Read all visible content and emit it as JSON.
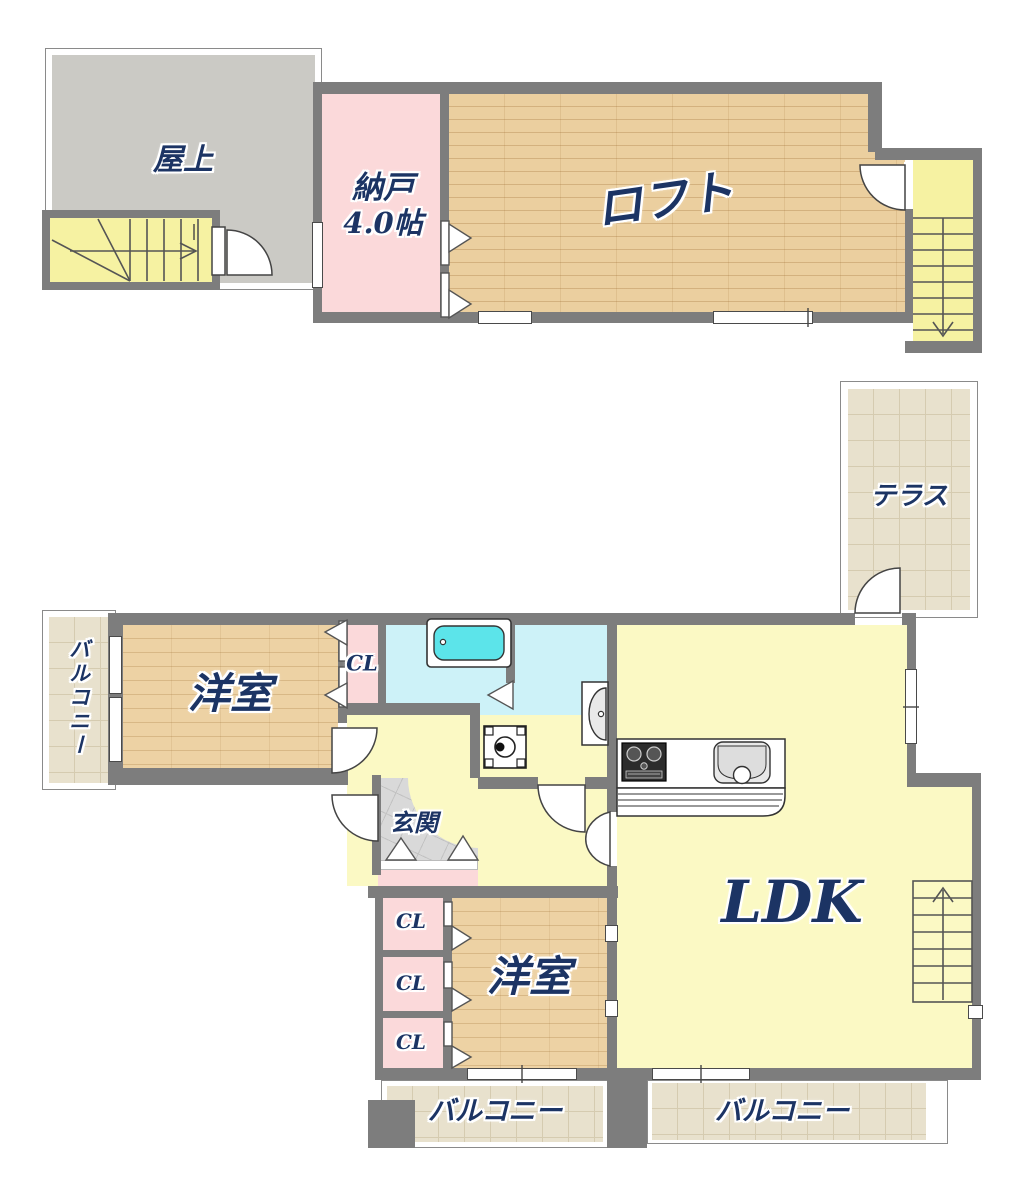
{
  "rooms": {
    "rooftop": "屋上",
    "storage": "納戸",
    "storage_size": "4.0帖",
    "loft": "ロフト",
    "terrace": "テラス",
    "balcony_side": "バルコニー",
    "western_upper": "洋室",
    "closet_upper": "CL",
    "entrance": "玄関",
    "ldk": "LDK",
    "closet_1": "CL",
    "closet_2": "CL",
    "closet_3": "CL",
    "western_lower": "洋室",
    "balcony_bottom_left": "バルコニー",
    "balcony_bottom_right": "バルコニー"
  },
  "colors": {
    "wall": "#7d7d7d",
    "label_navy": "#1c3464",
    "wood_floor": "#ebcf9f",
    "tile_beige": "#e8e1cd",
    "closet_pink": "#fbd9da",
    "stair_yellow": "#f6f2a2",
    "ldk_yellow": "#fbf9c4",
    "bath_cyan": "#cdf2f8",
    "bathtub_cyan": "#5ce4ea",
    "rooftop_gray": "#cbcac5"
  }
}
